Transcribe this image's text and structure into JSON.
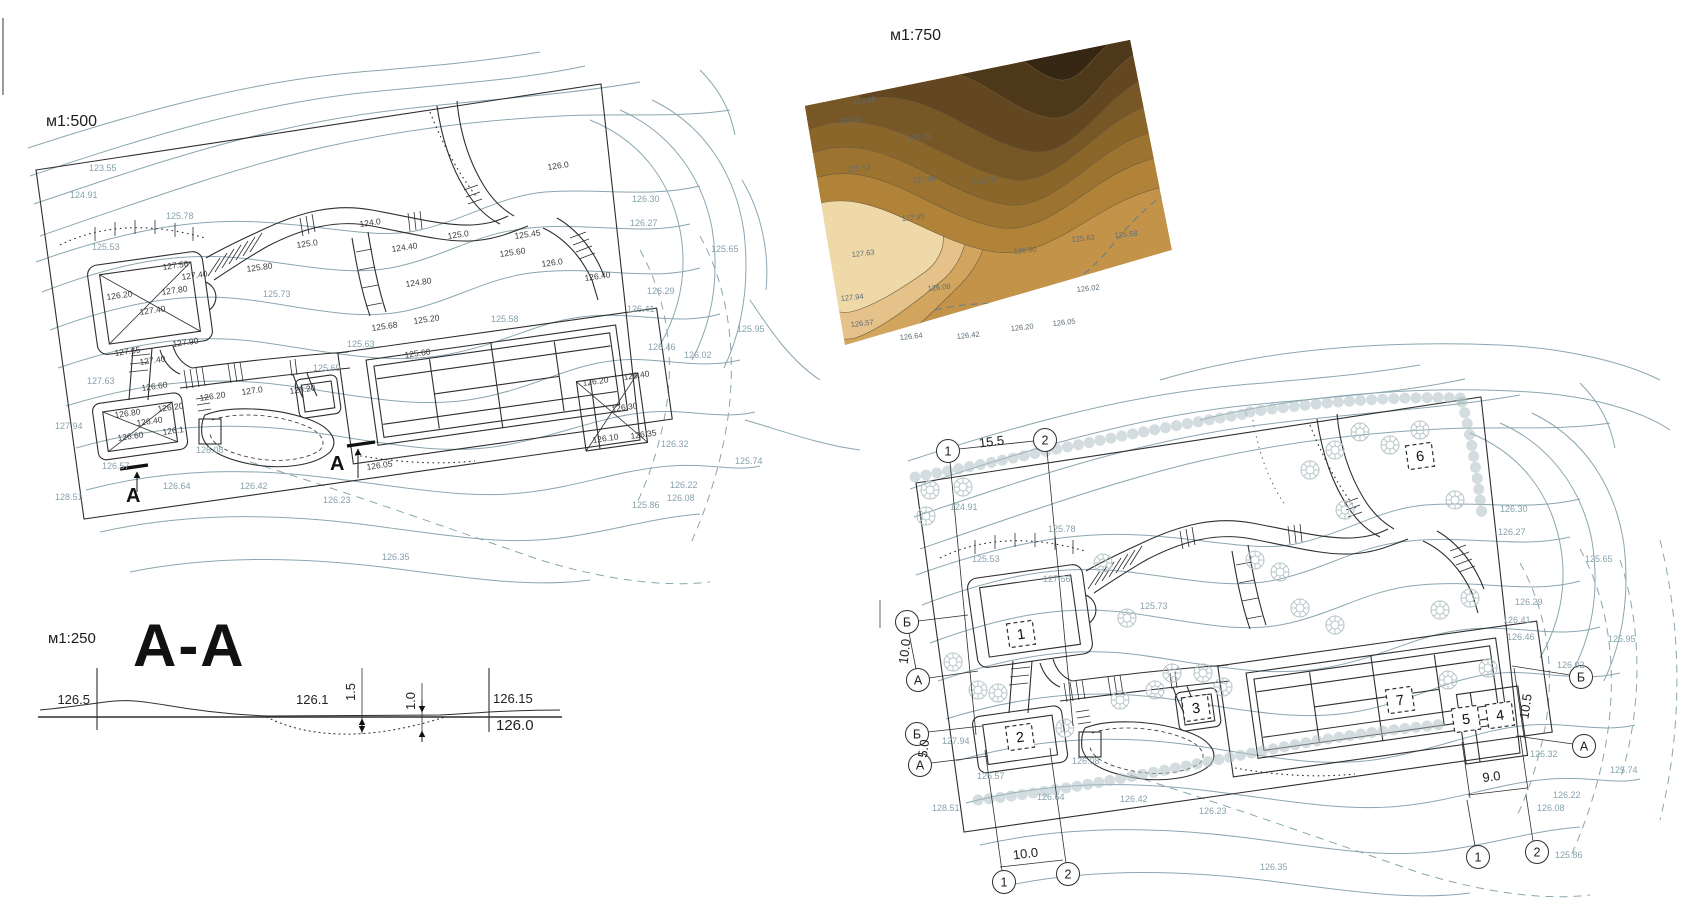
{
  "colors": {
    "contour_line": "#8aa6b0",
    "ink": "#2e2e2e",
    "spot_label": "#3a3a3a",
    "map_label": "#5d6d78",
    "dashed_blue": "#5f7d95",
    "tree": "#b5c4c7"
  },
  "map_palette": [
    "#c3934a",
    "#b08338",
    "#9c7430",
    "#8a662b",
    "#775726",
    "#634720",
    "#4e381a",
    "#352713",
    "#d2a55e",
    "#e5c28a",
    "#f0d9a8"
  ],
  "panels": {
    "plan500": {
      "scale": "м1:500",
      "section_letter": "A",
      "section_marks": [
        {
          "t": "A",
          "x": 126,
          "y": 502
        },
        {
          "t": "A",
          "x": 330,
          "y": 470
        }
      ],
      "contour_labels": [
        {
          "t": "123.55",
          "x": 89,
          "y": 171
        },
        {
          "t": "124.91",
          "x": 70,
          "y": 198
        },
        {
          "t": "125.78",
          "x": 166,
          "y": 219
        },
        {
          "t": "125.53",
          "x": 92,
          "y": 250
        },
        {
          "t": "125.73",
          "x": 263,
          "y": 297
        },
        {
          "t": "125.63",
          "x": 347,
          "y": 347
        },
        {
          "t": "125.69",
          "x": 313,
          "y": 371
        },
        {
          "t": "127.63",
          "x": 87,
          "y": 384
        },
        {
          "t": "127.94",
          "x": 55,
          "y": 429
        },
        {
          "t": "126.08",
          "x": 196,
          "y": 453
        },
        {
          "t": "126.57",
          "x": 102,
          "y": 469
        },
        {
          "t": "128.51",
          "x": 55,
          "y": 500
        },
        {
          "t": "126.64",
          "x": 163,
          "y": 489
        },
        {
          "t": "126.42",
          "x": 240,
          "y": 489
        },
        {
          "t": "126.23",
          "x": 323,
          "y": 503
        },
        {
          "t": "126.35",
          "x": 382,
          "y": 560
        },
        {
          "t": "125.58",
          "x": 491,
          "y": 322
        },
        {
          "t": "126.30",
          "x": 632,
          "y": 202
        },
        {
          "t": "126.27",
          "x": 630,
          "y": 226
        },
        {
          "t": "125.65",
          "x": 711,
          "y": 252
        },
        {
          "t": "126.29",
          "x": 647,
          "y": 294
        },
        {
          "t": "126.41",
          "x": 627,
          "y": 312
        },
        {
          "t": "125.95",
          "x": 737,
          "y": 332
        },
        {
          "t": "126.46",
          "x": 648,
          "y": 350
        },
        {
          "t": "126.02",
          "x": 684,
          "y": 358
        },
        {
          "t": "126.32",
          "x": 661,
          "y": 447
        },
        {
          "t": "125.74",
          "x": 735,
          "y": 464
        },
        {
          "t": "126.22",
          "x": 670,
          "y": 488
        },
        {
          "t": "126.08",
          "x": 667,
          "y": 501
        },
        {
          "t": "125.86",
          "x": 632,
          "y": 508
        }
      ],
      "spot_labels": [
        {
          "t": "127.56",
          "x": 163,
          "y": 270
        },
        {
          "t": "127.40",
          "x": 182,
          "y": 280
        },
        {
          "t": "126.20",
          "x": 107,
          "y": 300
        },
        {
          "t": "127.80",
          "x": 162,
          "y": 295
        },
        {
          "t": "127.40",
          "x": 140,
          "y": 315
        },
        {
          "t": "127.65",
          "x": 115,
          "y": 356
        },
        {
          "t": "127.90",
          "x": 173,
          "y": 347
        },
        {
          "t": "127.40",
          "x": 140,
          "y": 365
        },
        {
          "t": "124.0",
          "x": 360,
          "y": 227
        },
        {
          "t": "125.0",
          "x": 297,
          "y": 248
        },
        {
          "t": "125.80",
          "x": 247,
          "y": 272
        },
        {
          "t": "124.40",
          "x": 392,
          "y": 252
        },
        {
          "t": "124.80",
          "x": 406,
          "y": 287
        },
        {
          "t": "125.20",
          "x": 414,
          "y": 324
        },
        {
          "t": "125.0",
          "x": 448,
          "y": 239
        },
        {
          "t": "125.60",
          "x": 500,
          "y": 257
        },
        {
          "t": "125.45",
          "x": 515,
          "y": 239
        },
        {
          "t": "126.0",
          "x": 542,
          "y": 267
        },
        {
          "t": "126.0",
          "x": 548,
          "y": 170
        },
        {
          "t": "126.40",
          "x": 585,
          "y": 281
        },
        {
          "t": "125.60",
          "x": 405,
          "y": 358
        },
        {
          "t": "125.68",
          "x": 372,
          "y": 331
        },
        {
          "t": "126.60",
          "x": 142,
          "y": 391
        },
        {
          "t": "126.20",
          "x": 200,
          "y": 401
        },
        {
          "t": "127.0",
          "x": 242,
          "y": 395
        },
        {
          "t": "126.20",
          "x": 290,
          "y": 394
        },
        {
          "t": "126.80",
          "x": 115,
          "y": 418
        },
        {
          "t": "126.20",
          "x": 158,
          "y": 412
        },
        {
          "t": "126.40",
          "x": 137,
          "y": 426
        },
        {
          "t": "126.60",
          "x": 118,
          "y": 441
        },
        {
          "t": "126.1",
          "x": 163,
          "y": 435
        },
        {
          "t": "126.05",
          "x": 367,
          "y": 470
        },
        {
          "t": "126.20",
          "x": 583,
          "y": 386
        },
        {
          "t": "126.40",
          "x": 624,
          "y": 380
        },
        {
          "t": "126.30",
          "x": 612,
          "y": 412
        },
        {
          "t": "126.10",
          "x": 593,
          "y": 443
        },
        {
          "t": "126.35",
          "x": 631,
          "y": 439
        }
      ]
    },
    "map750": {
      "scale": "м1:750",
      "labels": [
        {
          "t": "123.55",
          "x": 853,
          "y": 104
        },
        {
          "t": "124.91",
          "x": 840,
          "y": 124
        },
        {
          "t": "125.78",
          "x": 908,
          "y": 141
        },
        {
          "t": "125.53",
          "x": 848,
          "y": 172
        },
        {
          "t": "127.56",
          "x": 913,
          "y": 183
        },
        {
          "t": "125.73",
          "x": 973,
          "y": 184
        },
        {
          "t": "127.95",
          "x": 902,
          "y": 221
        },
        {
          "t": "127.63",
          "x": 852,
          "y": 257
        },
        {
          "t": "125.58",
          "x": 1115,
          "y": 238
        },
        {
          "t": "125.63",
          "x": 1072,
          "y": 242
        },
        {
          "t": "126.60",
          "x": 1014,
          "y": 254
        },
        {
          "t": "126.08",
          "x": 928,
          "y": 291
        },
        {
          "t": "126.02",
          "x": 1077,
          "y": 292
        },
        {
          "t": "127.94",
          "x": 841,
          "y": 301
        },
        {
          "t": "126.57",
          "x": 851,
          "y": 327
        },
        {
          "t": "126.20",
          "x": 1011,
          "y": 331
        },
        {
          "t": "126.05",
          "x": 1053,
          "y": 326
        },
        {
          "t": "126.64",
          "x": 900,
          "y": 340
        },
        {
          "t": "126.42",
          "x": 957,
          "y": 339
        }
      ]
    },
    "section": {
      "scale": "м1:250",
      "title": "A-A",
      "labels": {
        "left": "126.5",
        "mid": "126.1",
        "right_top": "126.15",
        "right_bottom": "126.0",
        "dim_deep": "1.5",
        "dim_shallow": "1.0"
      }
    },
    "plan_working": {
      "axis_bubbles": [
        {
          "t": "1",
          "x": 948,
          "y": 451
        },
        {
          "t": "2",
          "x": 1045,
          "y": 440
        },
        {
          "t": "Б",
          "x": 907,
          "y": 622
        },
        {
          "t": "А",
          "x": 918,
          "y": 680
        },
        {
          "t": "Б",
          "x": 917,
          "y": 734
        },
        {
          "t": "А",
          "x": 920,
          "y": 765
        },
        {
          "t": "1",
          "x": 1004,
          "y": 882
        },
        {
          "t": "2",
          "x": 1068,
          "y": 874
        },
        {
          "t": "Б",
          "x": 1581,
          "y": 677
        },
        {
          "t": "А",
          "x": 1584,
          "y": 746
        },
        {
          "t": "1",
          "x": 1478,
          "y": 857
        },
        {
          "t": "2",
          "x": 1537,
          "y": 852
        }
      ],
      "dims": [
        {
          "t": "15.5",
          "x": 992,
          "y": 446,
          "r": -7
        },
        {
          "t": "10.0",
          "x": 909,
          "y": 652,
          "r": -83
        },
        {
          "t": "5.0",
          "x": 928,
          "y": 749,
          "r": -83
        },
        {
          "t": "10.0",
          "x": 1026,
          "y": 858,
          "r": -7
        },
        {
          "t": "9.0",
          "x": 1492,
          "y": 781,
          "r": -7
        },
        {
          "t": "10.5",
          "x": 1530,
          "y": 707,
          "r": -82
        }
      ],
      "item_numbers": [
        {
          "t": "1",
          "x": 1021,
          "y": 634
        },
        {
          "t": "2",
          "x": 1020,
          "y": 737
        },
        {
          "t": "3",
          "x": 1196,
          "y": 708
        },
        {
          "t": "4",
          "x": 1500,
          "y": 715
        },
        {
          "t": "5",
          "x": 1466,
          "y": 719
        },
        {
          "t": "6",
          "x": 1420,
          "y": 456
        },
        {
          "t": "7",
          "x": 1400,
          "y": 700
        }
      ],
      "contour_labels": [
        {
          "t": "124.91",
          "x": 950,
          "y": 510
        },
        {
          "t": "125.78",
          "x": 1048,
          "y": 532
        },
        {
          "t": "125.53",
          "x": 972,
          "y": 562
        },
        {
          "t": "127.56",
          "x": 1043,
          "y": 582
        },
        {
          "t": "125.73",
          "x": 1140,
          "y": 609
        },
        {
          "t": "127.94",
          "x": 942,
          "y": 744
        },
        {
          "t": "126.57",
          "x": 977,
          "y": 779
        },
        {
          "t": "128.51",
          "x": 932,
          "y": 811
        },
        {
          "t": "126.64",
          "x": 1037,
          "y": 800
        },
        {
          "t": "126.42",
          "x": 1120,
          "y": 802
        },
        {
          "t": "126.08",
          "x": 1072,
          "y": 764
        },
        {
          "t": "126.23",
          "x": 1199,
          "y": 814
        },
        {
          "t": "126.35",
          "x": 1260,
          "y": 870
        },
        {
          "t": "126.30",
          "x": 1500,
          "y": 512
        },
        {
          "t": "126.27",
          "x": 1498,
          "y": 535
        },
        {
          "t": "125.65",
          "x": 1585,
          "y": 562
        },
        {
          "t": "126.29",
          "x": 1515,
          "y": 605
        },
        {
          "t": "126.41",
          "x": 1503,
          "y": 623
        },
        {
          "t": "125.95",
          "x": 1608,
          "y": 642
        },
        {
          "t": "126.46",
          "x": 1507,
          "y": 640
        },
        {
          "t": "126.02",
          "x": 1557,
          "y": 668
        },
        {
          "t": "126.32",
          "x": 1530,
          "y": 757
        },
        {
          "t": "125.74",
          "x": 1610,
          "y": 773
        },
        {
          "t": "126.22",
          "x": 1553,
          "y": 798
        },
        {
          "t": "126.08",
          "x": 1537,
          "y": 811
        },
        {
          "t": "125.86",
          "x": 1555,
          "y": 858
        }
      ]
    }
  }
}
